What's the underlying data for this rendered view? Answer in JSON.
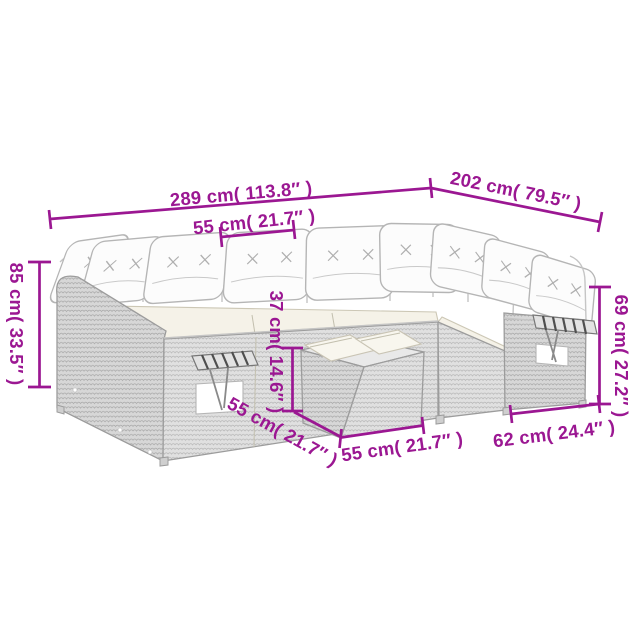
{
  "figure": {
    "type": "product-dimension-diagram",
    "subject": "grey poly-rattan corner garden sofa set with cream cushions, fold-out side trays and footstool table",
    "background_color": "#ffffff",
    "drawing_color": "#9c9c9c",
    "accent_color": "#9B1792"
  },
  "annotations": [
    {
      "id": "overall-length",
      "cm": 289,
      "inch": 113.8,
      "label": "289 cm( 113.8″ )"
    },
    {
      "id": "overall-side-depth",
      "cm": 202,
      "inch": 79.5,
      "label": "202 cm( 79.5″ )"
    },
    {
      "id": "seat-width-top",
      "cm": 55,
      "inch": 21.7,
      "label": "55 cm( 21.7″ )"
    },
    {
      "id": "back-height-left",
      "cm": 85,
      "inch": 33.5,
      "label": "85 cm( 33.5″ )"
    },
    {
      "id": "table-height",
      "cm": 37,
      "inch": 14.6,
      "label": "37 cm( 14.6″ )"
    },
    {
      "id": "arm-height-right",
      "cm": 69,
      "inch": 27.2,
      "label": "69 cm( 27.2″ )"
    },
    {
      "id": "table-depth-left",
      "cm": 55,
      "inch": 21.7,
      "label": "55 cm( 21.7″ )"
    },
    {
      "id": "table-width-bottom",
      "cm": 55,
      "inch": 21.7,
      "label": "55 cm( 21.7″ )"
    },
    {
      "id": "arm-section-depth",
      "cm": 62,
      "inch": 24.4,
      "label": "62 cm( 24.4″ )"
    }
  ]
}
